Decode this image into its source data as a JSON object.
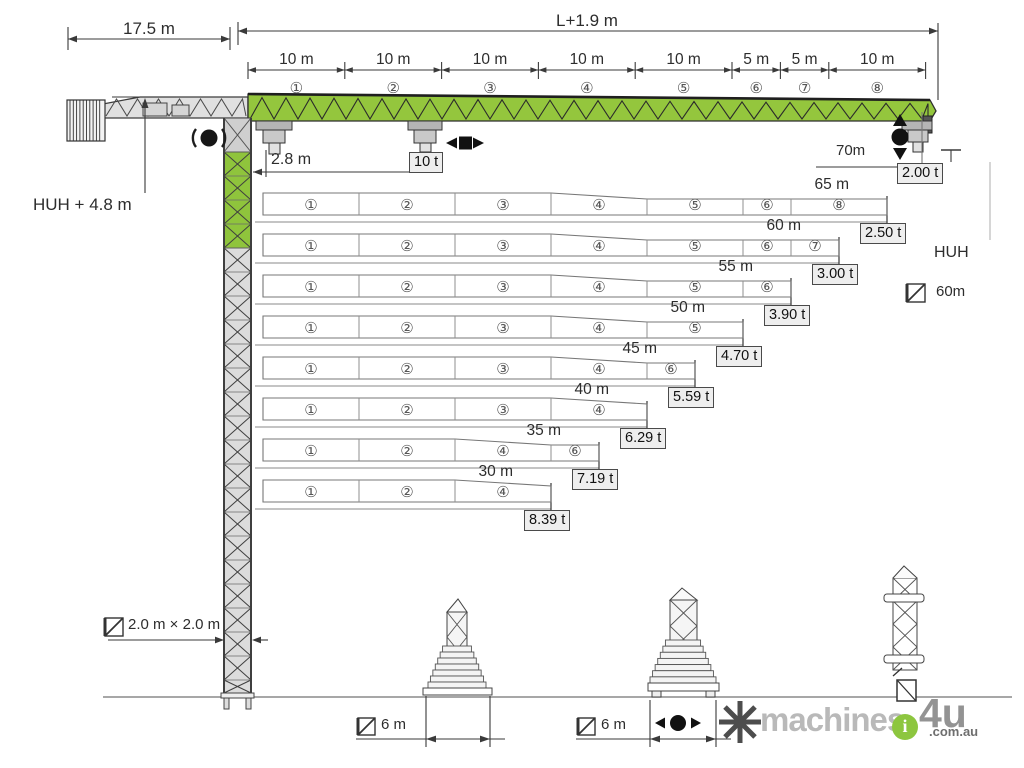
{
  "colors": {
    "jib_green": "#94c63d",
    "lattice_gray": "#dcdcdc",
    "line_dark": "#3a3a3a",
    "box_bg": "#eeeeee",
    "brand_green": "#8dc63f"
  },
  "top": {
    "counter_jib_length": "17.5 m",
    "jib_length_formula": "L+1.9 m",
    "segments": [
      {
        "circle": "①",
        "dim": "10 m",
        "len": 10
      },
      {
        "circle": "②",
        "dim": "10 m",
        "len": 10
      },
      {
        "circle": "③",
        "dim": "10 m",
        "len": 10
      },
      {
        "circle": "④",
        "dim": "10 m",
        "len": 10
      },
      {
        "circle": "⑤",
        "dim": "10 m",
        "len": 10
      },
      {
        "circle": "⑥",
        "dim": "5 m",
        "len": 5
      },
      {
        "circle": "⑦",
        "dim": "5 m",
        "len": 5
      },
      {
        "circle": "⑧",
        "dim": "10 m",
        "len": 10
      }
    ]
  },
  "labels": {
    "hook_height_left": "HUH + 4.8 m",
    "min_radius": "2.8 m",
    "max_capacity": "10 t",
    "tip_radius": "70m",
    "tip_capacity": "2.00 t",
    "hook_height_right": "HUH",
    "tower_option": "60m",
    "tower_section": "2.0 m × 2.0 m",
    "base_left": "6 m",
    "base_right": "6 m"
  },
  "load_chart": {
    "type": "table",
    "description": "Jib configurations: radius vs tip capacity with jib segment combinations",
    "rows": [
      {
        "radius": "65 m",
        "radius_m": 65,
        "capacity": "2.50 t",
        "segments": [
          {
            "n": "①",
            "len": 10
          },
          {
            "n": "②",
            "len": 10
          },
          {
            "n": "③",
            "len": 10
          },
          {
            "n": "④",
            "len": 10
          },
          {
            "n": "⑤",
            "len": 10
          },
          {
            "n": "⑥",
            "len": 5
          },
          {
            "n": "⑧",
            "len": 10
          }
        ]
      },
      {
        "radius": "60 m",
        "radius_m": 60,
        "capacity": "3.00 t",
        "segments": [
          {
            "n": "①",
            "len": 10
          },
          {
            "n": "②",
            "len": 10
          },
          {
            "n": "③",
            "len": 10
          },
          {
            "n": "④",
            "len": 10
          },
          {
            "n": "⑤",
            "len": 10
          },
          {
            "n": "⑥",
            "len": 5
          },
          {
            "n": "⑦",
            "len": 5
          }
        ]
      },
      {
        "radius": "55 m",
        "radius_m": 55,
        "capacity": "3.90 t",
        "segments": [
          {
            "n": "①",
            "len": 10
          },
          {
            "n": "②",
            "len": 10
          },
          {
            "n": "③",
            "len": 10
          },
          {
            "n": "④",
            "len": 10
          },
          {
            "n": "⑤",
            "len": 10
          },
          {
            "n": "⑥",
            "len": 5
          }
        ]
      },
      {
        "radius": "50 m",
        "radius_m": 50,
        "capacity": "4.70 t",
        "segments": [
          {
            "n": "①",
            "len": 10
          },
          {
            "n": "②",
            "len": 10
          },
          {
            "n": "③",
            "len": 10
          },
          {
            "n": "④",
            "len": 10
          },
          {
            "n": "⑤",
            "len": 10
          }
        ]
      },
      {
        "radius": "45 m",
        "radius_m": 45,
        "capacity": "5.59 t",
        "segments": [
          {
            "n": "①",
            "len": 10
          },
          {
            "n": "②",
            "len": 10
          },
          {
            "n": "③",
            "len": 10
          },
          {
            "n": "④",
            "len": 10
          },
          {
            "n": "⑥",
            "len": 5
          }
        ]
      },
      {
        "radius": "40 m",
        "radius_m": 40,
        "capacity": "6.29 t",
        "segments": [
          {
            "n": "①",
            "len": 10
          },
          {
            "n": "②",
            "len": 10
          },
          {
            "n": "③",
            "len": 10
          },
          {
            "n": "④",
            "len": 10
          }
        ]
      },
      {
        "radius": "35 m",
        "radius_m": 35,
        "capacity": "7.19 t",
        "segments": [
          {
            "n": "①",
            "len": 10
          },
          {
            "n": "②",
            "len": 10
          },
          {
            "n": "④",
            "len": 10
          },
          {
            "n": "⑥",
            "len": 5
          }
        ]
      },
      {
        "radius": "30 m",
        "radius_m": 30,
        "capacity": "8.39 t",
        "segments": [
          {
            "n": "①",
            "len": 10
          },
          {
            "n": "②",
            "len": 10
          },
          {
            "n": "④",
            "len": 10
          }
        ]
      }
    ]
  },
  "watermark": {
    "brand": "machines",
    "brand2": "4u",
    "suffix": ".com.au",
    "badge": "i"
  }
}
